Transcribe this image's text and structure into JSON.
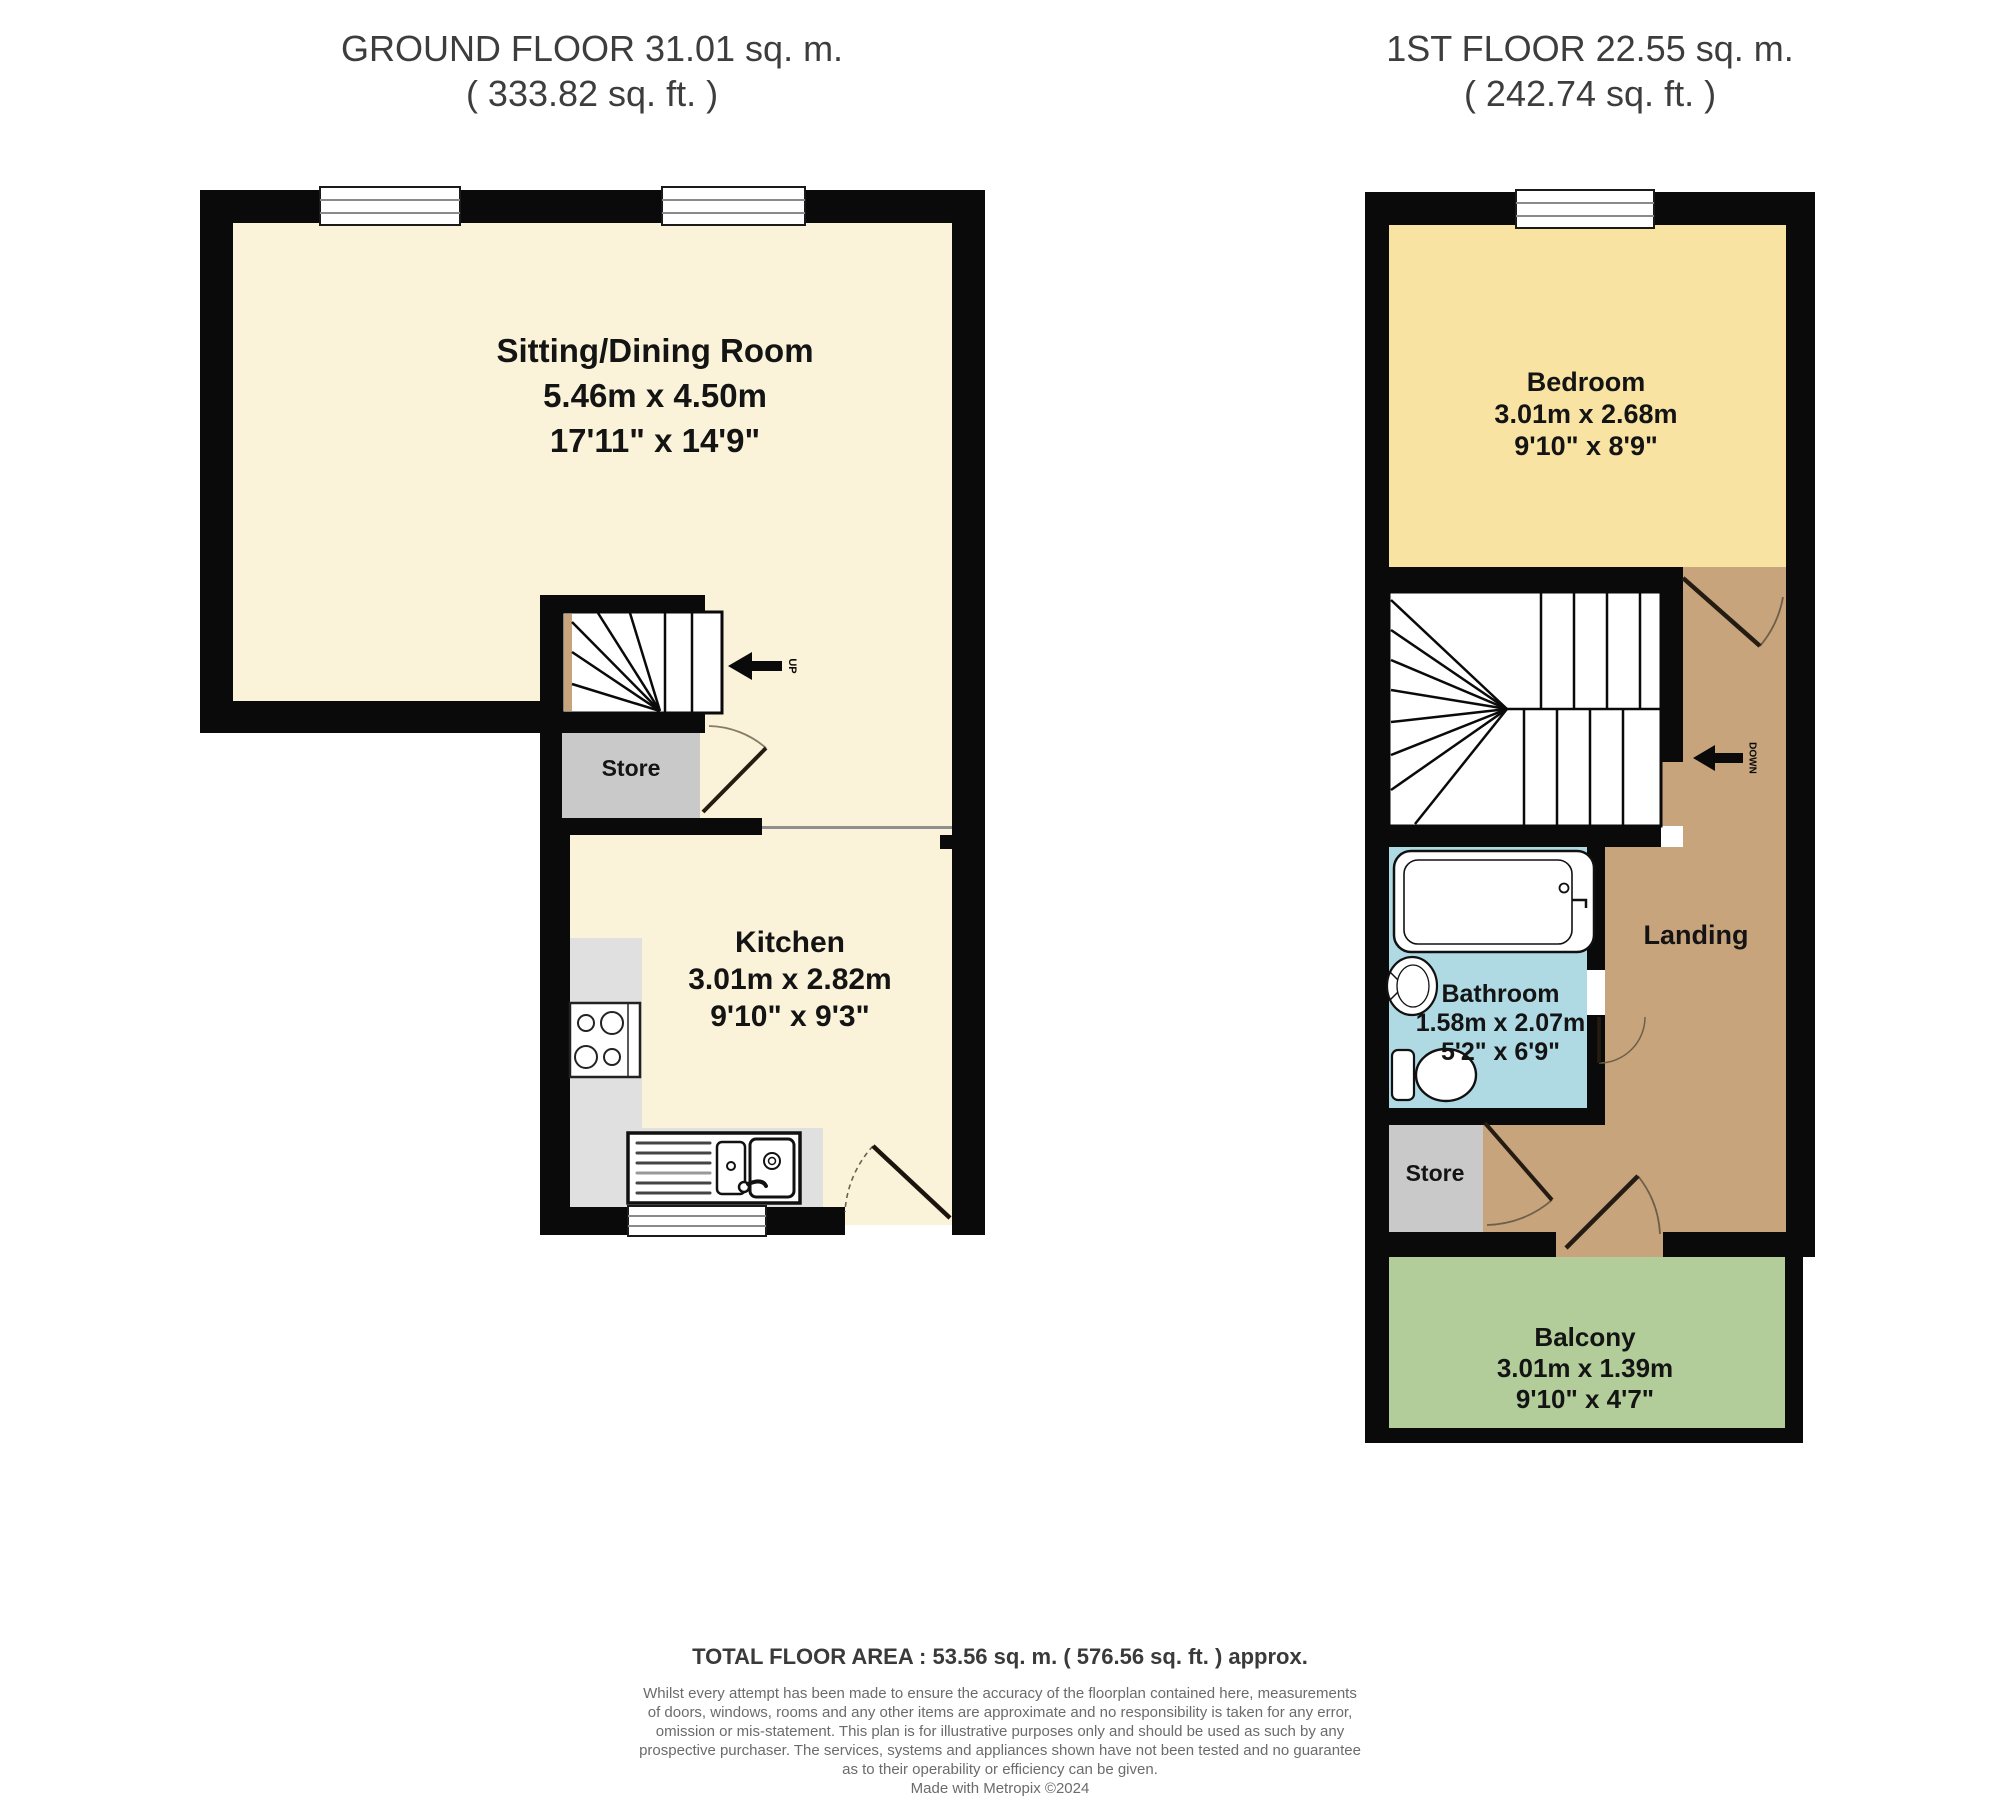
{
  "ground_floor": {
    "title": "GROUND FLOOR 31.01 sq. m.",
    "subtitle": "( 333.82 sq. ft. )",
    "rooms": {
      "sitting": {
        "name": "Sitting/Dining Room",
        "metric": "5.46m x 4.50m",
        "imperial": "17'11\" x 14'9\""
      },
      "kitchen": {
        "name": "Kitchen",
        "metric": "3.01m x 2.82m",
        "imperial": "9'10\" x 9'3\""
      },
      "store": {
        "name": "Store"
      }
    },
    "stairs_label": "UP"
  },
  "first_floor": {
    "title": "1ST FLOOR 22.55 sq. m.",
    "subtitle": "( 242.74 sq. ft. )",
    "rooms": {
      "bedroom": {
        "name": "Bedroom",
        "metric": "3.01m x 2.68m",
        "imperial": "9'10\" x 8'9\""
      },
      "bathroom": {
        "name": "Bathroom",
        "metric": "1.58m x 2.07m",
        "imperial": "5'2\" x 6'9\""
      },
      "landing": {
        "name": "Landing"
      },
      "store": {
        "name": "Store"
      },
      "balcony": {
        "name": "Balcony",
        "metric": "3.01m x 1.39m",
        "imperial": "9'10\" x 4'7\""
      }
    },
    "stairs_label": "DOWN"
  },
  "footer": {
    "total": "TOTAL FLOOR AREA : 53.56 sq. m. ( 576.56 sq. ft. ) approx.",
    "disclaimer_lines": [
      "Whilst every attempt has been made to ensure the accuracy of the floorplan contained here, measurements",
      "of doors, windows, rooms and any other items are approximate and no responsibility is taken for any error,",
      "omission or mis-statement. This plan is for illustrative purposes only and should be used as such by any",
      "prospective purchaser. The services, systems and appliances shown have not been tested and no guarantee",
      "as to their operability or efficiency can be given.",
      "Made with Metropix ©2024"
    ]
  },
  "colors": {
    "wall": "#0a0a0a",
    "room_cream": "#FAF3D9",
    "bedroom_yellow": "#F8E3A3",
    "landing_tan": "#C8A47D",
    "bathroom_blue": "#AFDAE3",
    "balcony_green": "#B2CD9A",
    "store_grey": "#C9C9C9",
    "counter_grey": "#E0E0E0"
  }
}
